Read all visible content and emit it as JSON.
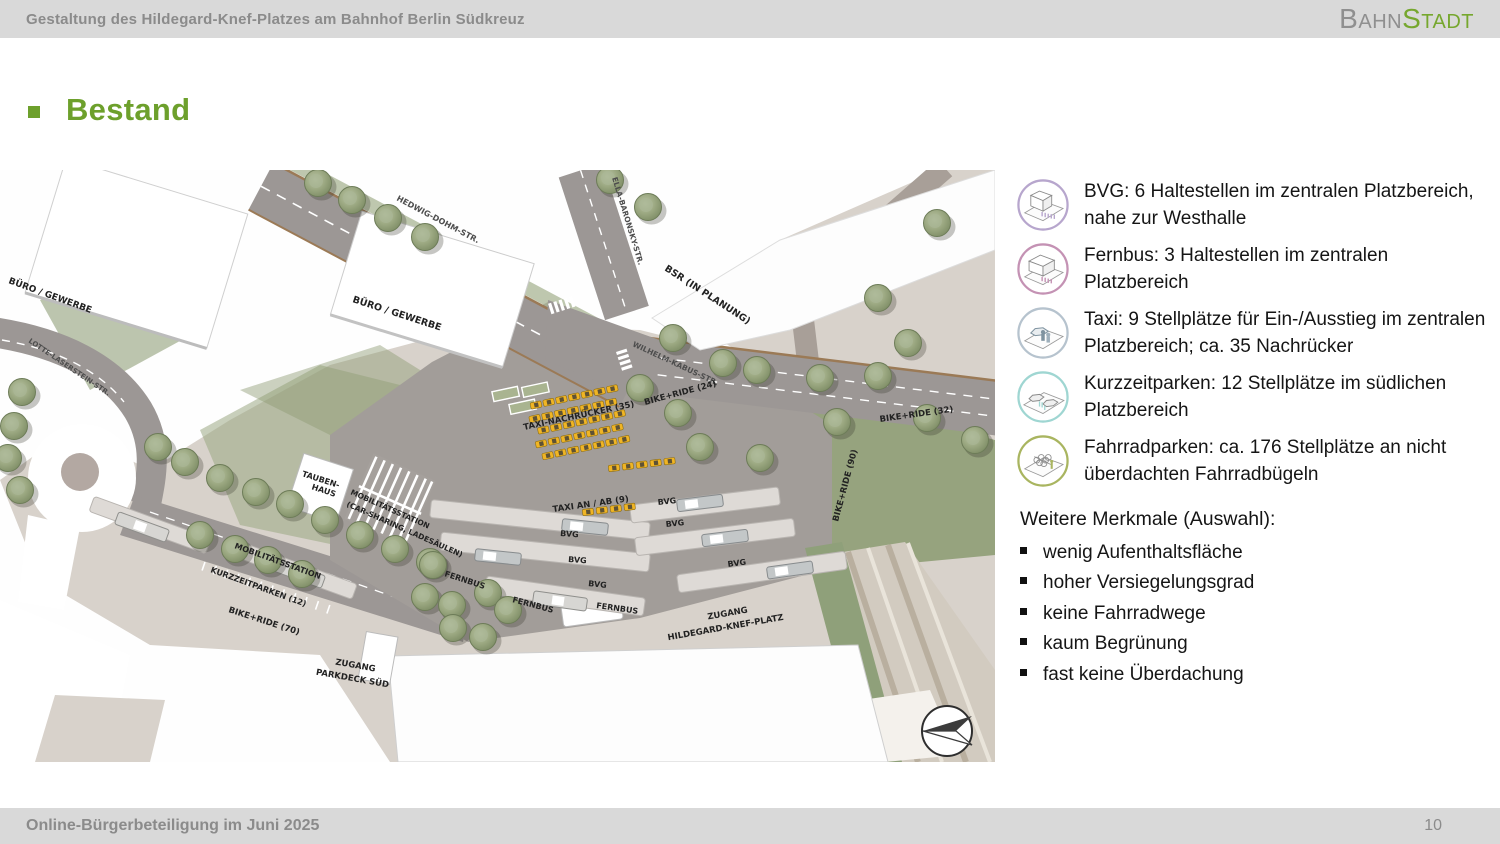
{
  "theme": {
    "accent_green": "#6da02c",
    "bar_gray": "#d9d9d9",
    "bar_text_gray": "#8b8b8b"
  },
  "header": {
    "title": "Gestaltung des Hildegard-Knef-Platzes am Bahnhof Berlin Südkreuz",
    "logo": {
      "part1": "Bahn",
      "part2": "Stadt"
    }
  },
  "slide": {
    "title": "Bestand"
  },
  "legend": {
    "items": [
      {
        "icon": "bvg-stop-icon",
        "color": "#b7a6cd",
        "text": "BVG: 6 Haltestellen im zentralen Platzbereich, nahe zur Westhalle"
      },
      {
        "icon": "fernbus-stop-icon",
        "color": "#c492b4",
        "text": "Fernbus: 3 Haltestellen im zentralen Platzbereich"
      },
      {
        "icon": "taxi-icon",
        "color": "#b6c3ce",
        "text": "Taxi: 9 Stellplätze für Ein-/Ausstieg im zentralen Platzbereich; ca. 35 Nachrücker"
      },
      {
        "icon": "kurzzeitparken-icon",
        "color": "#9fd6d2",
        "text": "Kurzzeitparken: 12 Stellplätze im südlichen Platzbereich"
      },
      {
        "icon": "fahrradparken-icon",
        "color": "#a9b560",
        "text": "Fahrradparken: ca. 176 Stellplätze an nicht überdachten Fahrradbügeln"
      }
    ]
  },
  "merkmale": {
    "heading": "Weitere Merkmale (Auswahl):",
    "items": [
      "wenig Aufenthaltsfläche",
      "hoher Versiegelungsgrad",
      "keine Fahrradwege",
      "kaum Begrünung",
      "fast keine Überdachung"
    ]
  },
  "map": {
    "labels": {
      "buero_top": "BÜRO / GEWERBE",
      "buero_center": "BÜRO / GEWERBE",
      "hedwig": "HEDWIG-DOHM-STR.",
      "ella": "ELLA-BARONSKY-STR.",
      "bsr": "BSR (IN PLANUNG)",
      "wilhelm": "WILHELM-KABUS-STR.",
      "lotte": "LOTTE-LASERSTEIN-STR.",
      "taxi_nachruecker": "TAXI-NACHRÜCKER (35)",
      "taxi_an_ab": "TAXI AN / AB (9)",
      "bvg": "BVG",
      "fernbus": "FERNBUS",
      "bike24": "BIKE+RIDE (24)",
      "bike32": "BIKE+RIDE (32)",
      "bike90": "BIKE+RIDE (90)",
      "bike70": "BIKE+RIDE (70)",
      "tauben1": "TAUBEN-",
      "tauben2": "HAUS",
      "mobil_station": "MOBILITÄTSSTATION",
      "mobil_carsharing": "(CAR-SHARING, LADESÄULEN)",
      "mobil2": "MOBILITÄTSSTATION",
      "kurzzeitparken": "KURZZEITPARKEN (12)",
      "zugang": "ZUGANG",
      "zugang_parkdeck": "PARKDECK SÜD",
      "zugang_hkp": "HILDEGARD-KNEF-PLATZ"
    }
  },
  "footer": {
    "left": "Online-Bürgerbeteiligung im Juni 2025",
    "page": "10"
  }
}
